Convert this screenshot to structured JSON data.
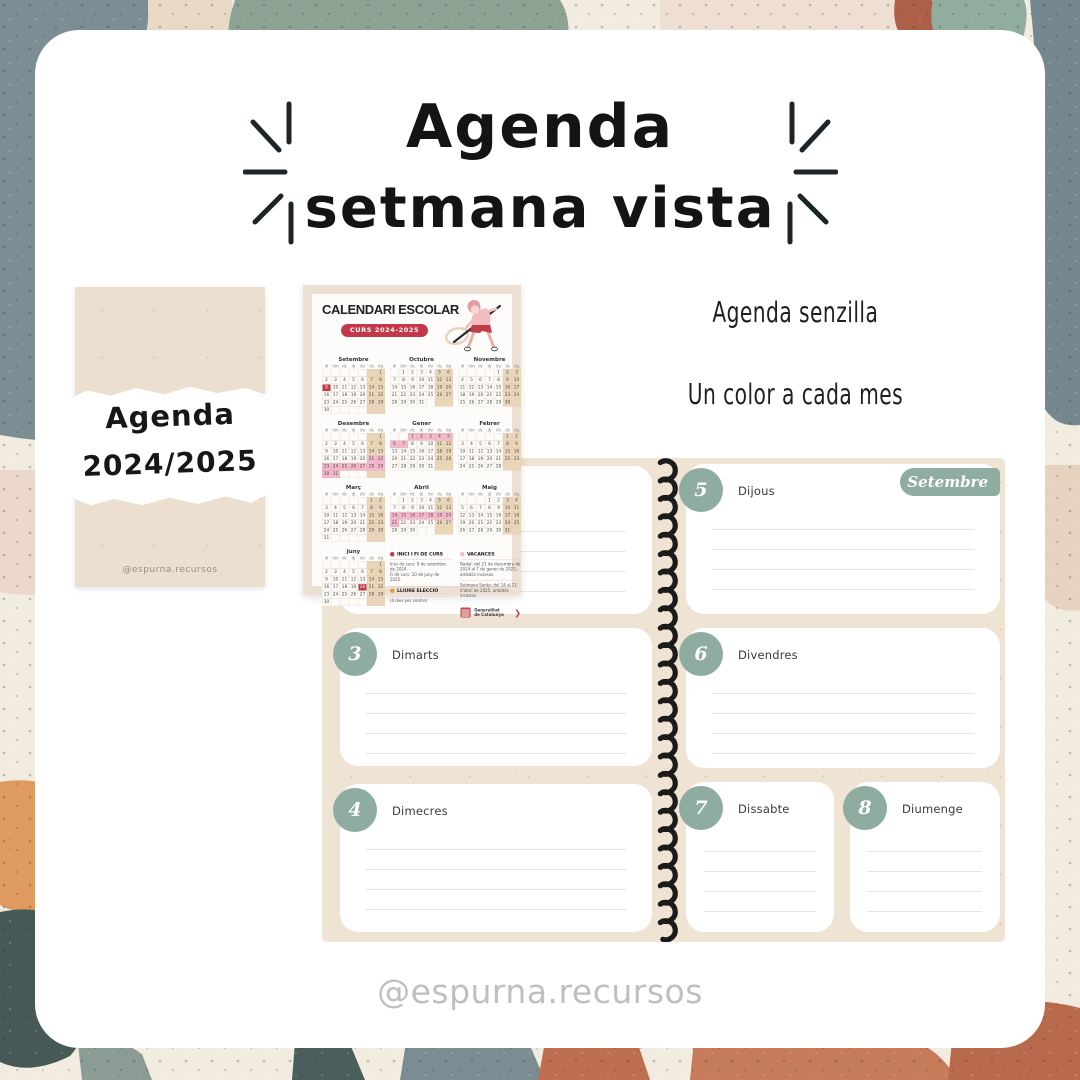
{
  "title": {
    "line1": "Agenda",
    "line2": "setmana vista"
  },
  "cover": {
    "line1": "Agenda",
    "line2": "2024/2025",
    "credit": "@espurna.recursos"
  },
  "school_calendar": {
    "title": "CALENDARI ESCOLAR",
    "badge": "CURS 2024-2025",
    "day_headers": [
      "dl",
      "dm",
      "dc",
      "dj",
      "dv",
      "ds",
      "dg"
    ],
    "months": [
      {
        "name": "Setembre",
        "days": 30,
        "offset": 6,
        "red": [
          9
        ]
      },
      {
        "name": "Octubre",
        "days": 31,
        "offset": 1
      },
      {
        "name": "Novembre",
        "days": 30,
        "offset": 4
      },
      {
        "name": "Desembre",
        "days": 31,
        "offset": 6,
        "pink": [
          21,
          22,
          23,
          24,
          25,
          26,
          27,
          28,
          29,
          30,
          31
        ]
      },
      {
        "name": "Gener",
        "days": 31,
        "offset": 2,
        "pink": [
          1,
          2,
          3,
          4,
          5,
          6,
          7
        ]
      },
      {
        "name": "Febrer",
        "days": 28,
        "offset": 5
      },
      {
        "name": "Març",
        "days": 31,
        "offset": 5
      },
      {
        "name": "Abril",
        "days": 30,
        "offset": 1,
        "pink": [
          14,
          15,
          16,
          17,
          18,
          19,
          20,
          21
        ]
      },
      {
        "name": "Maig",
        "days": 31,
        "offset": 3
      },
      {
        "name": "Juny",
        "days": 30,
        "offset": 6,
        "red": [
          20
        ]
      }
    ],
    "legend": {
      "inici_label": "INICI I FI DE CURS",
      "inici_note1": "Inici de curs: 9 de setembre de 2024.",
      "inici_note2": "Fi de curs: 20 de juny de 2025.",
      "lliure_label": "LLIURE ELECCIÓ",
      "lliure_note": "(4 dies per centre)",
      "vacances_label": "VACANCES",
      "vacances_note1": "Nadal: del 21 de desembre de 2024 al 7 de gener de 2025, ambdós inclosos.",
      "vacances_note2": "Setmana Santa: del 14 al 21 d'abril de 2025, ambdós inclosos."
    },
    "logo_line1": "Generalitat",
    "logo_line2": "de Catalunya"
  },
  "features": {
    "line1": "Agenda senzilla",
    "line2": "Un color a cada mes"
  },
  "week_spread": {
    "month_tab": "Setembre",
    "days": [
      {
        "number": "3",
        "name": "Dimarts"
      },
      {
        "number": "4",
        "name": "Dimecres"
      },
      {
        "number": "5",
        "name": "Dijous"
      },
      {
        "number": "6",
        "name": "Divendres"
      },
      {
        "number": "7",
        "name": "Dissabte"
      },
      {
        "number": "8",
        "name": "Diumenge"
      }
    ]
  },
  "footer": {
    "handle": "@espurna.recursos"
  },
  "colors": {
    "accent_sage": "#8FACA1",
    "accent_red": "#C4394A",
    "vacances_pink": "#F2BACB",
    "weekend_tan": "#EAD6B9",
    "spread_beige": "#EFE3D3"
  }
}
